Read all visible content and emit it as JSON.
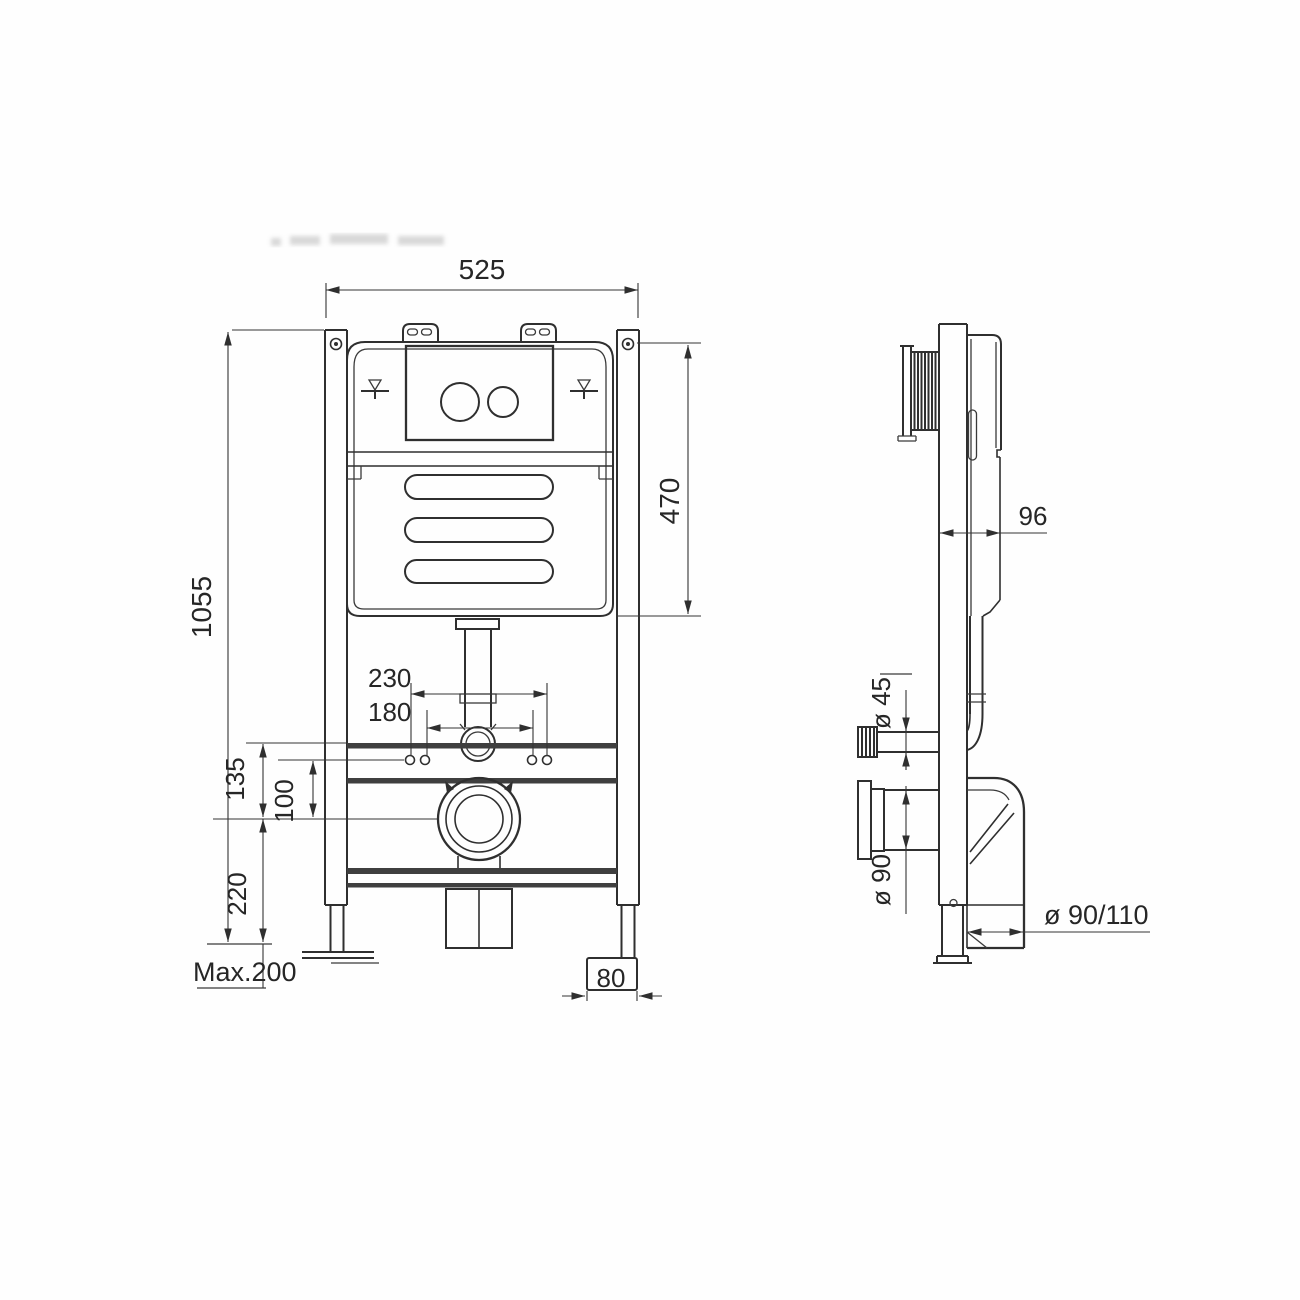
{
  "drawing": {
    "front_view": {
      "dim_overall_width": "525",
      "dim_overall_height": "1055",
      "dim_top_to_cistern_bottom": "470",
      "dim_fixing_outer": "230",
      "dim_fixing_inner": "180",
      "dim_rail_to_waste": "135",
      "dim_fixing_to_waste": "100",
      "dim_waste_height": "220",
      "dim_leg_extension": "Max.200",
      "dim_foot_width": "80"
    },
    "side_view": {
      "dim_depth": "96",
      "dim_flush_pipe_dia": "ø 45",
      "dim_waste_pipe_dia": "ø 90",
      "dim_outlet_dia": "ø 90/110"
    }
  }
}
